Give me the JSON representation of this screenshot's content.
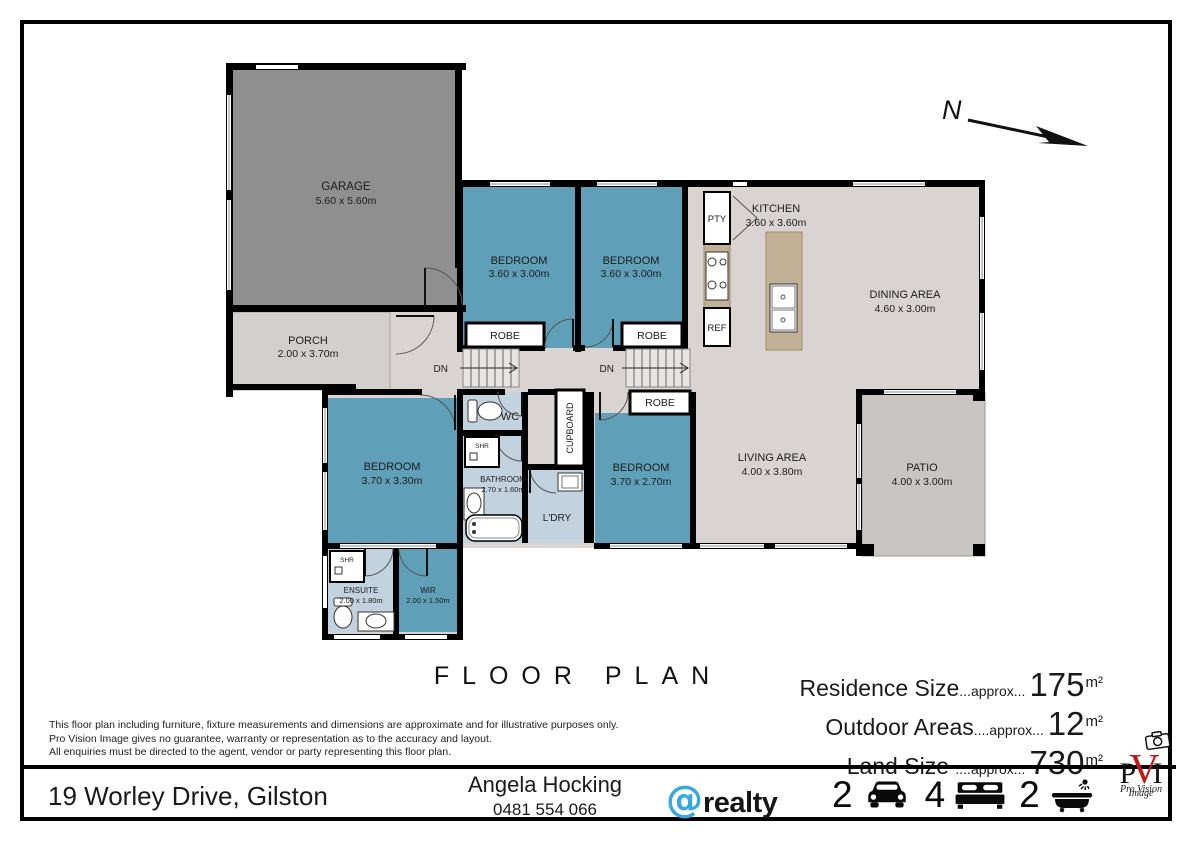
{
  "title": "FLOOR PLAN",
  "compass": {
    "label": "N"
  },
  "plan": {
    "garage": {
      "name": "GARAGE",
      "dims": "5.60 x 5.60m"
    },
    "porch": {
      "name": "PORCH",
      "dims": "2.00 x 3.70m"
    },
    "bedroom_top_left": {
      "name": "BEDROOM",
      "dims": "3.60 x 3.00m"
    },
    "bedroom_top_right": {
      "name": "BEDROOM",
      "dims": "3.60 x 3.00m"
    },
    "kitchen": {
      "name": "KITCHEN",
      "dims": "3.60 x 3.60m"
    },
    "dining": {
      "name": "DINING AREA",
      "dims": "4.60 x 3.00m"
    },
    "living": {
      "name": "LIVING AREA",
      "dims": "4.00 x 3.80m"
    },
    "patio": {
      "name": "PATIO",
      "dims": "4.00 x 3.00m"
    },
    "bedroom_master": {
      "name": "BEDROOM",
      "dims": "3.70 x 3.30m"
    },
    "bedroom_lower": {
      "name": "BEDROOM",
      "dims": "3.70 x 2.70m"
    },
    "bathroom": {
      "name": "BATHROOM",
      "dims": "2.70 x 1.60m"
    },
    "ensuite": {
      "name": "ENSUITE",
      "dims": "2.00 x 1.80m"
    },
    "wir": {
      "name": "WIR",
      "dims": "2.00 x 1.50m"
    },
    "wc": "WC",
    "ldry": "L'DRY",
    "cupboard": "CUPBOARD",
    "pty": "PTY",
    "ref": "REF",
    "shr": "SHR",
    "robe": "ROBE",
    "dn": "DN"
  },
  "sizes": [
    {
      "label": "Residence Size",
      "dots": "...approx...",
      "value": "175",
      "unit": "m²"
    },
    {
      "label": "Outdoor Areas",
      "dots": "....approx...",
      "value": "12",
      "unit": "m²"
    },
    {
      "label": "Land Size ",
      "dots": "....approx...",
      "value": "730",
      "unit": "m²"
    }
  ],
  "disclaimer": [
    "This floor plan including furniture, fixture measurements and dimensions are approximate and for illustrative purposes only.",
    "Pro Vision Image gives no guarantee, warranty or representation as to the accuracy and layout.",
    "All enquiries must be directed to the agent, vendor or party representing this floor plan."
  ],
  "footer": {
    "address": "19 Worley Drive, Gilston",
    "agent_name": "Angela Hocking",
    "agent_phone": "0481 554 066",
    "brand_at": "@",
    "brand_name": "realty",
    "stats": [
      {
        "value": "2",
        "icon": "car"
      },
      {
        "value": "4",
        "icon": "bed"
      },
      {
        "value": "2",
        "icon": "bath"
      }
    ]
  },
  "provision": {
    "p": "P",
    "v": "V",
    "i": "I",
    "line1": "Pro Vision",
    "line2": "Image"
  },
  "colors": {
    "bedroom_fill": "#5f9fb8",
    "wet_fill": "#c2d3df",
    "floor_fill": "#d9d4d1",
    "garage_fill": "#8f8f8f",
    "porch_fill": "#d3cfcc",
    "patio_fill": "#c8c5c2",
    "bench_fill": "#c3b197",
    "wall": "#000000",
    "brand_blue": "#35a8dc",
    "logo_red": "#c41818"
  }
}
